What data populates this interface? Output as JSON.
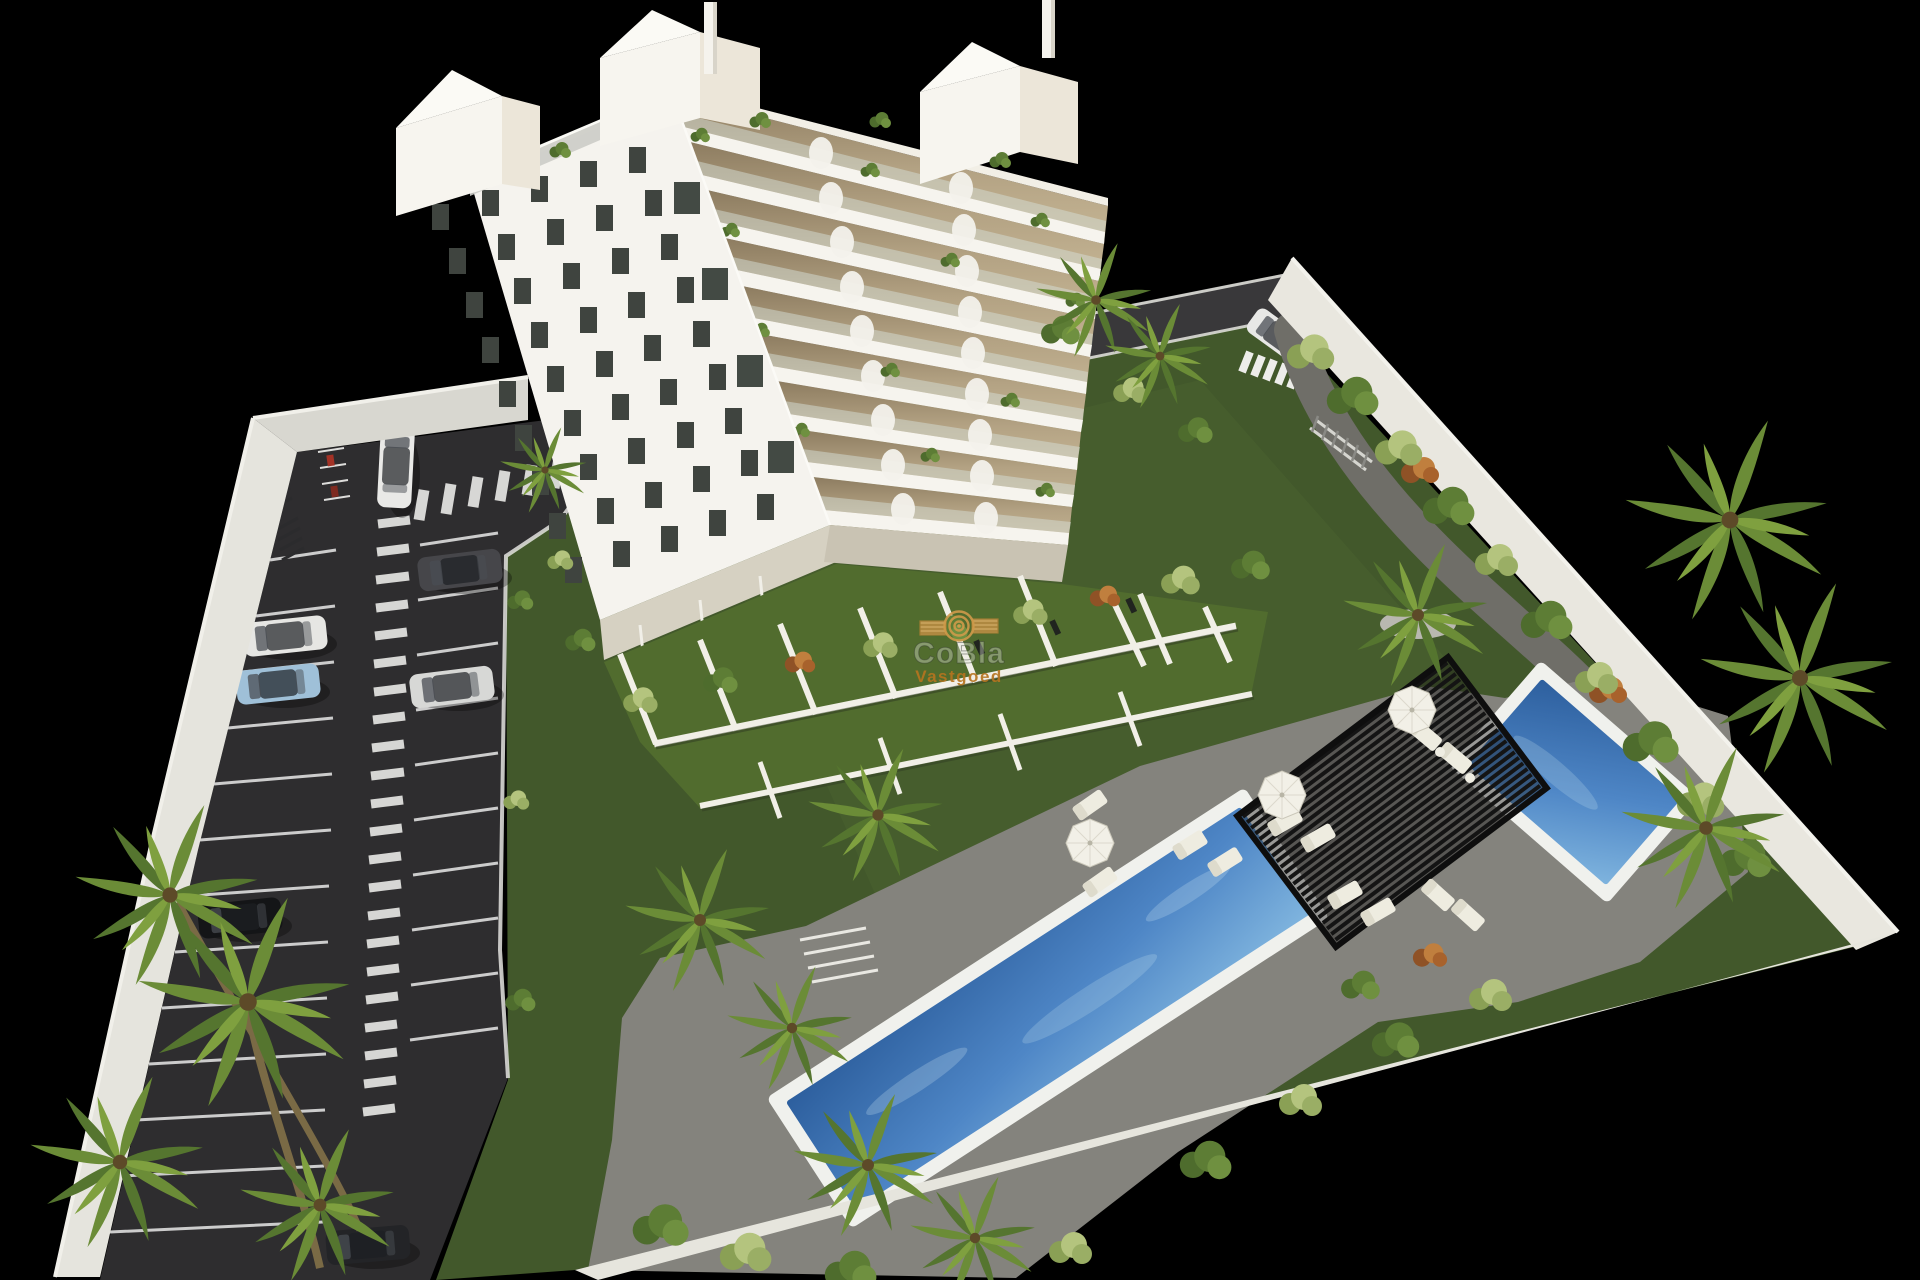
{
  "watermark": {
    "title": "CoBla",
    "subtitle": "Vastgoed",
    "logo_icon": "concentric-arcs-logo",
    "accent_orange": "#b5741f",
    "logo_tan": "#d9a75f"
  },
  "scene": {
    "type": "3d-architectural-site-render",
    "background_color": "#000000",
    "building": {
      "label": "white apartment tower with balconies and roof terraces",
      "floors_visible": 9,
      "facade_color": "#f5f3ee",
      "balcony_recess_color": "#b7a687",
      "window_color": "#3f443f"
    },
    "parking": {
      "label": "walled parking lot",
      "surface_color": "#2e2d2f",
      "marking_color": "#e8e8e8",
      "features": [
        "zebra-crossing",
        "pedestrian-ladder-marking",
        "bicycle-racks",
        "motorcycle-bays"
      ],
      "cars": [
        {
          "color_name": "white",
          "state": "driving"
        },
        {
          "color_name": "dark-gray",
          "state": "parked"
        },
        {
          "color_name": "white",
          "state": "parked"
        },
        {
          "color_name": "light-blue",
          "state": "parked"
        },
        {
          "color_name": "silver",
          "state": "parked"
        },
        {
          "color_name": "black",
          "state": "parked"
        },
        {
          "color_name": "dark-gray",
          "state": "parked"
        },
        {
          "color_name": "white",
          "state": "driving-rear-road"
        }
      ]
    },
    "amenities": {
      "pools": [
        {
          "label": "long lap pool",
          "water_colors": [
            "#2d5f9e",
            "#7fb4de"
          ]
        },
        {
          "label": "small pool",
          "water_colors": [
            "#2d5f9e",
            "#7fb4de"
          ]
        }
      ],
      "pergola": {
        "label": "black slatted pergola",
        "color": "#141414"
      },
      "sun_loungers": 12,
      "parasols": 3
    },
    "landscape": {
      "lawn_color": "#42582b",
      "deck_color": "#84837d",
      "path_color": "#6f6e68",
      "perimeter_wall_color": "#e9e8e1",
      "palm_trees": true,
      "private_garden_terraces": true
    }
  }
}
